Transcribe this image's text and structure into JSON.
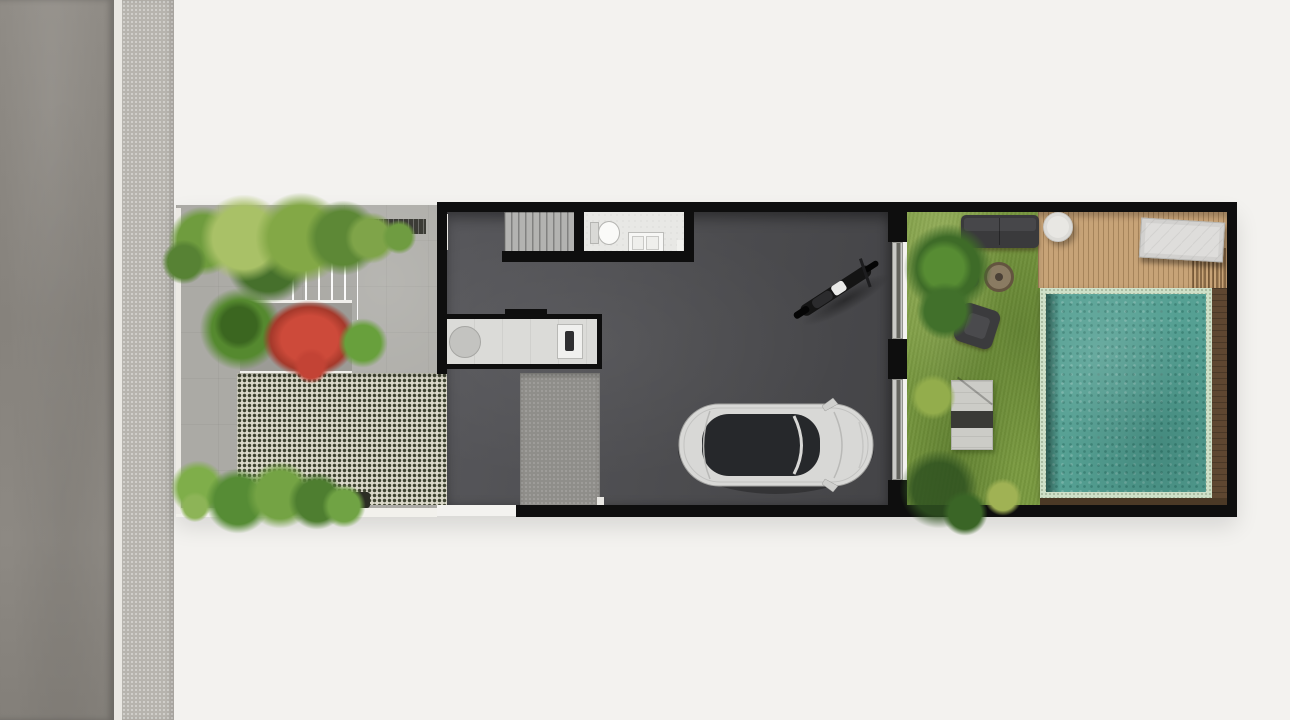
{
  "scene": {
    "kind": "architectural-site-plan-top-view",
    "areas": {
      "street": "asphalt road strip at far left",
      "sidewalk": "light concrete strip beside road",
      "front_garden": "paved courtyard with trees, stepped path, red flowering shrub and grass-block driveway",
      "house": "dark-floored long house with staircase, bathroom, kitchenette and garage",
      "garage": "open parking area with one car and one motorcycle",
      "backyard": "lawn with outdoor lounge furniture",
      "pool_zone": "timber deck with swimming pool at far right"
    },
    "objects": [
      "staircase",
      "bathroom-toilet",
      "bathroom-vanity",
      "kitchen-round-table",
      "kitchen-sink",
      "car-top-view",
      "motorcycle-top-view",
      "sliding-glass-door",
      "outdoor-sofa",
      "armchair",
      "armchair",
      "fire-pit",
      "garden-bench",
      "round-side-table",
      "sun-lounger",
      "swimming-pool",
      "lawn-tree",
      "red-shrub",
      "planter-bed",
      "grass-block-paving",
      "timber-deck"
    ],
    "counts": {
      "cars": 1,
      "motorcycles": 1,
      "armchairs": 2,
      "sofas": 1,
      "loungers": 1,
      "pools": 1
    }
  },
  "palette": {
    "bg": "#f3f2ef",
    "road": "#8b8781",
    "road_line": "#eae8e3",
    "sidewalk": "#b7b4ae",
    "paving": "#abaaa5",
    "paving_wall": "#eceae5",
    "checker_light": "#dbd9ca",
    "checker_dark": "#3f4431",
    "wall": "#0e0e0e",
    "floor_dark": "#4c4c4f",
    "concrete_pad": "#8f8e8a",
    "stairs": "#b3b3b1",
    "bath_floor": "#e8e8e5",
    "kitchen_floor": "#dbdbd8",
    "lawn": "#79993f",
    "deck": "#c7a377",
    "deck_dark": "#5e4731",
    "pool_tile": "#cfe0c8",
    "pool_water": "#55a093",
    "foliage_green": "#6f9c3e",
    "foliage_dark": "#3f672a",
    "shrub_red": "#cd4a3a",
    "furniture_dark": "#3a3a3c",
    "car_body": "#d8d8d6",
    "car_glass": "#26282b"
  }
}
